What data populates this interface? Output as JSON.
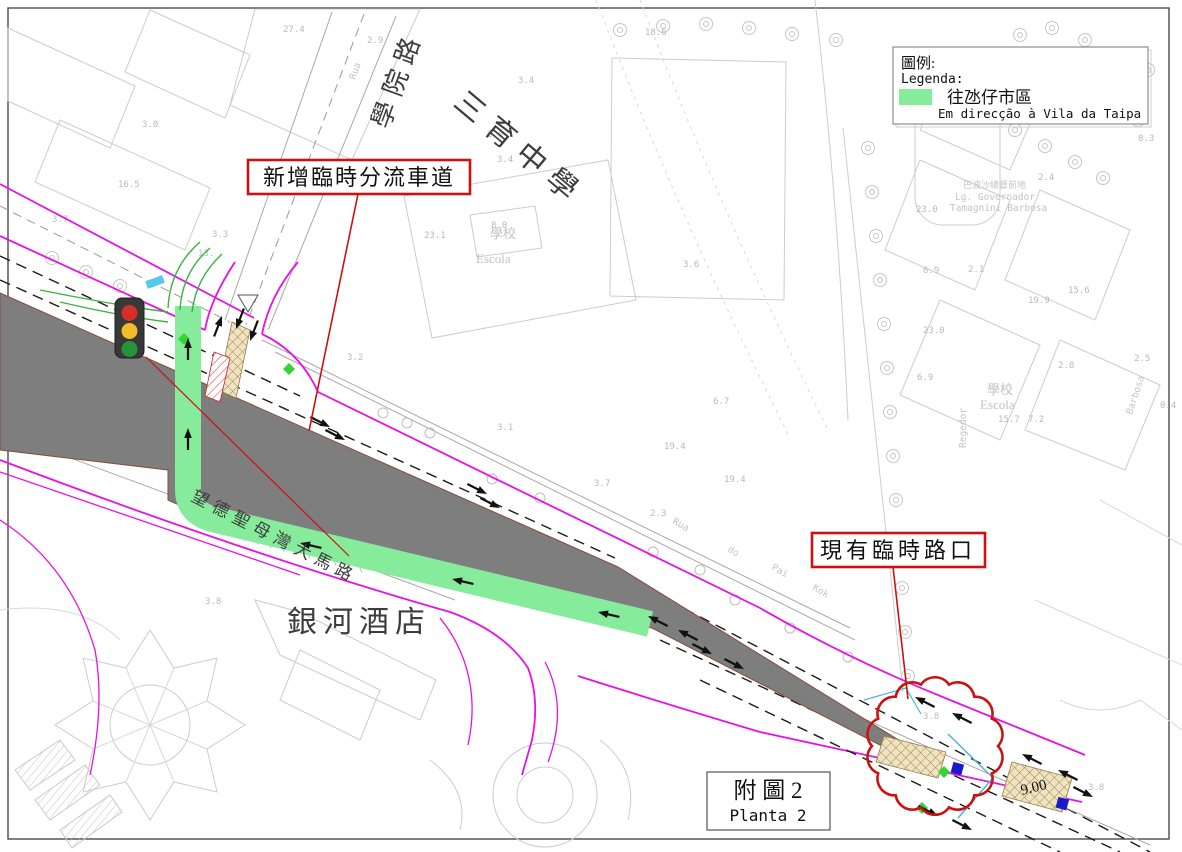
{
  "legend": {
    "title_cn": "圖例:",
    "title_pt": "Legenda:",
    "item_label_cn": "往氹仔市區",
    "item_label_pt": "Em direcção à Vila da Taipa",
    "swatch_color": "#86EC9C"
  },
  "callouts": {
    "new_lane": "新增臨時分流車道",
    "existing_junction": "現有臨時路口"
  },
  "title_block": {
    "cn": "附 圖 2",
    "pt": "Planta 2"
  },
  "map_labels": {
    "school_road": "學院路",
    "rua_top": "Rua",
    "sam_yuk_school": "三育中學",
    "escola_mid_cn": "學校",
    "escola_mid_pt": "Escola",
    "galaxy_hotel": "銀河酒店",
    "avenida": "望德聖母灣大馬路",
    "pai_kok": {
      "w1": "Rua",
      "w2": "do",
      "w3": "Pai",
      "w4": "Kok"
    },
    "largo_cn": "巴波沙總督前地",
    "largo_pt1": "Lg. Governador",
    "largo_pt2": "Tamagnini Barbosa",
    "escola_right_cn": "學校",
    "escola_right_pt": "Escola",
    "regedor": "Regedor",
    "barbosa": "Barbosa",
    "island_width": "9.00"
  },
  "measurements": [
    {
      "t": "27.4",
      "x": 283,
      "y": 32
    },
    {
      "t": "2.9",
      "x": 367,
      "y": 43
    },
    {
      "t": "3.0",
      "x": 142,
      "y": 127
    },
    {
      "t": "16.5",
      "x": 118,
      "y": 187
    },
    {
      "t": "3.7",
      "x": 52,
      "y": 222
    },
    {
      "t": "3.3",
      "x": 212,
      "y": 237
    },
    {
      "t": "13.",
      "x": 198,
      "y": 256
    },
    {
      "t": "18.6",
      "x": 645,
      "y": 35
    },
    {
      "t": "6.0",
      "x": 487,
      "y": 137
    },
    {
      "t": "3.4",
      "x": 518,
      "y": 83
    },
    {
      "t": "3.4",
      "x": 497,
      "y": 162
    },
    {
      "t": "23.1",
      "x": 424,
      "y": 238
    },
    {
      "t": "8.0",
      "x": 491,
      "y": 228
    },
    {
      "t": "3.6",
      "x": 683,
      "y": 267
    },
    {
      "t": "3.1",
      "x": 497,
      "y": 430
    },
    {
      "t": "3.7",
      "x": 594,
      "y": 486
    },
    {
      "t": "19.4",
      "x": 664,
      "y": 449
    },
    {
      "t": "19.4",
      "x": 724,
      "y": 482
    },
    {
      "t": "2.3",
      "x": 650,
      "y": 516
    },
    {
      "t": "3.8",
      "x": 205,
      "y": 604
    },
    {
      "t": "3.2",
      "x": 347,
      "y": 360
    },
    {
      "t": "23.0",
      "x": 916,
      "y": 212
    },
    {
      "t": "6.9",
      "x": 923,
      "y": 273
    },
    {
      "t": "23.0",
      "x": 923,
      "y": 333
    },
    {
      "t": "6.9",
      "x": 917,
      "y": 380
    },
    {
      "t": "2.4",
      "x": 1038,
      "y": 180
    },
    {
      "t": "2.1",
      "x": 968,
      "y": 272
    },
    {
      "t": "15.6",
      "x": 1068,
      "y": 293
    },
    {
      "t": "19.9",
      "x": 1028,
      "y": 303
    },
    {
      "t": "2.8",
      "x": 1058,
      "y": 368
    },
    {
      "t": "2.5",
      "x": 1134,
      "y": 361
    },
    {
      "t": "15.7",
      "x": 998,
      "y": 422
    },
    {
      "t": "7.2",
      "x": 1028,
      "y": 422
    },
    {
      "t": "0.4",
      "x": 1160,
      "y": 408
    },
    {
      "t": "8.3",
      "x": 1138,
      "y": 141
    },
    {
      "t": "3.8",
      "x": 923,
      "y": 719
    },
    {
      "t": "3.8",
      "x": 1088,
      "y": 790
    },
    {
      "t": "6.7",
      "x": 713,
      "y": 404
    }
  ],
  "colors": {
    "construction_gray": "#7E7E7E",
    "diversion_green": "#86EC9C",
    "road_magenta": "#E611E6",
    "annotation_red": "#CC1111"
  }
}
